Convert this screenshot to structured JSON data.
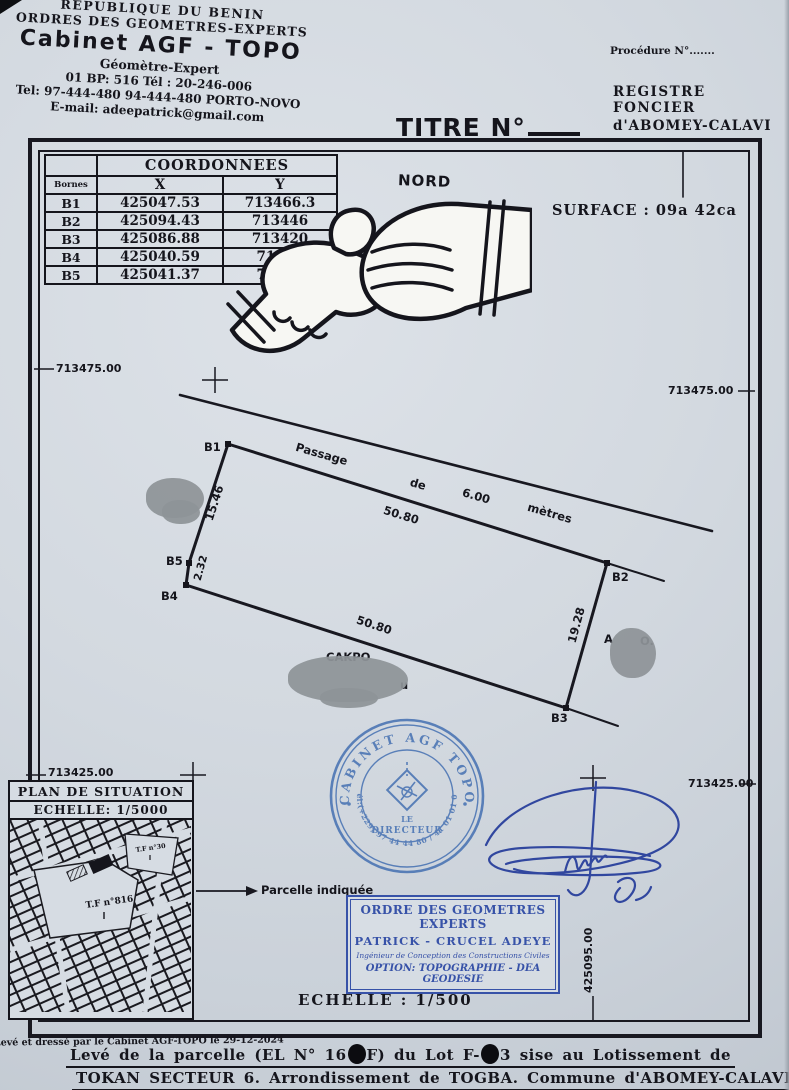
{
  "header": {
    "line1": "REPUBLIQUE DU BENIN",
    "line2": "ORDRES DES GEOMETRES-EXPERTS",
    "cabinet": "Cabinet AGF - TOPO",
    "subtitle": "Géomètre-Expert",
    "address1": "01 BP: 516 Tél : 20-246-006",
    "address2": "Tel: 97-444-480 94-444-480 PORTO-NOVO",
    "email": "E-mail: adeepatrick@gmail.com"
  },
  "registry": {
    "procedure": "Procédure N°.......",
    "line1": "REGISTRE FONCIER",
    "line2": "d'ABOMEY-CALAVI"
  },
  "title": {
    "label": "TITRE N°"
  },
  "coordinates_table": {
    "title": "COORDONNEES",
    "col_bornes": "Bornes",
    "col_x": "X",
    "col_y": "Y",
    "rows": [
      {
        "borne": "B1",
        "x": "425047.53",
        "y": "713466.3"
      },
      {
        "borne": "B2",
        "x": "425094.43",
        "y": "713446"
      },
      {
        "borne": "B3",
        "x": "425086.88",
        "y": "713420"
      },
      {
        "borne": "B4",
        "x": "425040.59",
        "y": "71345"
      },
      {
        "borne": "B5",
        "x": "425041.37",
        "y": "71345"
      }
    ]
  },
  "plan": {
    "north": "NORD",
    "surface": "SURFACE : 09a 42ca",
    "passage_words": [
      "Passage",
      "de",
      "6.00",
      "mètres"
    ],
    "dim_top": "50.80",
    "dim_bottom": "50.80",
    "dim_left": "15.46",
    "dim_left2": "2.32",
    "dim_right": "19.28",
    "bornes": {
      "b1": "B1",
      "b2": "B2",
      "b3": "B3",
      "b4": "B4",
      "b5": "B5"
    },
    "grid": {
      "top_left": "713475.00",
      "top_right": "713475.00",
      "bottom_left": "713425.00",
      "bottom_right": "713425.00",
      "x_left": "425045.00",
      "x_right": "425095.00"
    },
    "redactions": {
      "name_bottom": "CAKPO",
      "name_bottom_tail": "u",
      "name_right_a": "A",
      "name_right_b": "O."
    }
  },
  "situation": {
    "title": "PLAN DE SITUATION",
    "scale": "ECHELLE: 1/5000",
    "tf_main": "T.F n°816",
    "tf_secondary": "T.F n°30",
    "pointer_label": "Parcelle indiquée"
  },
  "stamp": {
    "arc_top": "CABINET AGF TOPO",
    "arc_bottom": "Tél:(+229) 97 44 44 80 / 41 01 01 01",
    "center_line1": "LE",
    "center_line2": "DIRECTEUR",
    "color": "#3f6cb0"
  },
  "order_box": {
    "line1": "ORDRE DES GEOMETRES EXPERTS",
    "line2": "PATRICK - CRUCEL ADEYE",
    "line3": "Ingénieur de Conception des Constructions Civiles",
    "line4": "OPTION: TOPOGRAPHIE - DEA GEODESIE"
  },
  "scale_label": "ECHELLE : 1/500",
  "footer": {
    "credit": "Levé et dressé par le Cabinet AGF-TOPO le 29-12-2024",
    "line1_part1": "Levé de la parcelle (EL N° 16",
    "line1_part2": "F) du Lot F-",
    "line1_part3": "3 sise au Lotissement de",
    "line2": "TOKAN SECTEUR 6. Arrondissement de TOGBA. Commune d'ABOMEY-CALAVI."
  },
  "colors": {
    "paper": "#d6dce3",
    "ink": "#15151c",
    "stamp_blue": "#3f6cb0",
    "signature_blue": "#31479f"
  }
}
